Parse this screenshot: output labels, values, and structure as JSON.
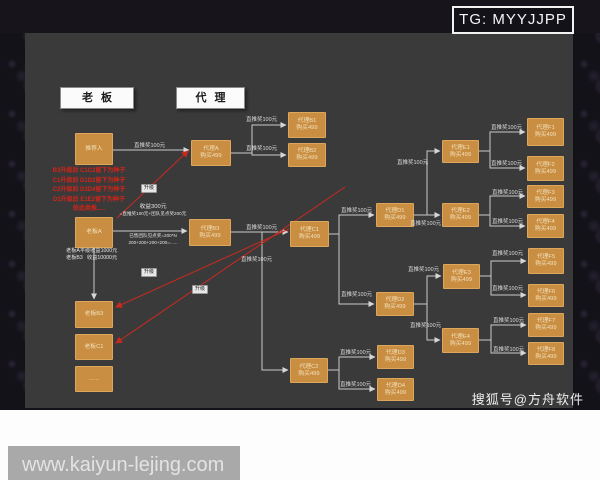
{
  "page": {
    "tg_badge": "TG: MYYJJPP",
    "souhu_watermark": "搜狐号@方舟软件",
    "url_watermark": "www.kaiyun-lejing.com"
  },
  "legend": {
    "boss": "老板",
    "agent": "代理"
  },
  "colors": {
    "panel": "#3b3a3b",
    "outer": "#141219",
    "node_fill": "#c98e41",
    "line": "#c9c9c9",
    "red": "#c92a1e"
  },
  "diagram": {
    "default_edge_label": "直推奖100元",
    "upgrade_label": "升级",
    "red_note_lines": [
      "B3升级后 C1C2留下为种子",
      "C1升级后 D1D2留下为种子",
      "C2升级后 D3D4留下为种子",
      "D1升级后 E1E2留下为种子",
      "依此类推....."
    ],
    "income_note": {
      "above": [
        "收益300元",
        "=直推奖100元+团队见点奖200元"
      ],
      "below": [
        "已售团队见点奖=200*N",
        "200+200+200+200=......"
      ]
    },
    "boss_income_lines": [
      "老板A平级收益1000元",
      "老板B3   收益10000元"
    ],
    "nodes": [
      {
        "id": "referrer",
        "label": "推荐人",
        "sub": "",
        "x": 75,
        "y": 133,
        "w": 38,
        "h": 32
      },
      {
        "id": "boss-a",
        "label": "老板A",
        "sub": "",
        "x": 75,
        "y": 217,
        "w": 38,
        "h": 31
      },
      {
        "id": "boss-b3",
        "label": "老板B3",
        "sub": "",
        "x": 75,
        "y": 301,
        "w": 38,
        "h": 27
      },
      {
        "id": "boss-c1",
        "label": "老板C1",
        "sub": "",
        "x": 75,
        "y": 334,
        "w": 38,
        "h": 26
      },
      {
        "id": "boss-more",
        "label": "......",
        "sub": "",
        "x": 75,
        "y": 366,
        "w": 38,
        "h": 26
      },
      {
        "id": "agent-a",
        "label": "代理A",
        "sub": "购买499",
        "x": 191,
        "y": 140,
        "w": 40,
        "h": 26
      },
      {
        "id": "agent-b3",
        "label": "代理B3",
        "sub": "购买499",
        "x": 189,
        "y": 219,
        "w": 42,
        "h": 27
      },
      {
        "id": "agent-b1",
        "label": "代理B1",
        "sub": "购买499",
        "x": 288,
        "y": 112,
        "w": 38,
        "h": 26
      },
      {
        "id": "agent-b2",
        "label": "代理B2",
        "sub": "购买499",
        "x": 288,
        "y": 143,
        "w": 38,
        "h": 24
      },
      {
        "id": "agent-c1",
        "label": "代理C1",
        "sub": "购买499",
        "x": 290,
        "y": 221,
        "w": 39,
        "h": 26
      },
      {
        "id": "agent-c2",
        "label": "代理C2",
        "sub": "购买499",
        "x": 290,
        "y": 358,
        "w": 38,
        "h": 25
      },
      {
        "id": "agent-d1",
        "label": "代理D1",
        "sub": "购买499",
        "x": 376,
        "y": 203,
        "w": 38,
        "h": 24
      },
      {
        "id": "agent-d2",
        "label": "代理D2",
        "sub": "购买499",
        "x": 376,
        "y": 292,
        "w": 38,
        "h": 24
      },
      {
        "id": "agent-d3",
        "label": "代理D3",
        "sub": "购买499",
        "x": 377,
        "y": 345,
        "w": 37,
        "h": 24
      },
      {
        "id": "agent-d4",
        "label": "代理D4",
        "sub": "购买499",
        "x": 377,
        "y": 378,
        "w": 37,
        "h": 23
      },
      {
        "id": "agent-e1",
        "label": "代理E1",
        "sub": "购买499",
        "x": 442,
        "y": 140,
        "w": 37,
        "h": 23
      },
      {
        "id": "agent-e2",
        "label": "代理E2",
        "sub": "购买499",
        "x": 442,
        "y": 203,
        "w": 37,
        "h": 24
      },
      {
        "id": "agent-e3",
        "label": "代理E3",
        "sub": "购买499",
        "x": 443,
        "y": 264,
        "w": 37,
        "h": 25
      },
      {
        "id": "agent-e4",
        "label": "代理E4",
        "sub": "购买499",
        "x": 442,
        "y": 328,
        "w": 37,
        "h": 25
      },
      {
        "id": "agent-f1",
        "label": "代理F1",
        "sub": "购买499",
        "x": 527,
        "y": 118,
        "w": 37,
        "h": 28
      },
      {
        "id": "agent-f2",
        "label": "代理F2",
        "sub": "购买499",
        "x": 527,
        "y": 156,
        "w": 37,
        "h": 25
      },
      {
        "id": "agent-f3",
        "label": "代理F3",
        "sub": "购买499",
        "x": 527,
        "y": 185,
        "w": 37,
        "h": 23
      },
      {
        "id": "agent-f4",
        "label": "代理F4",
        "sub": "购买499",
        "x": 527,
        "y": 214,
        "w": 37,
        "h": 24
      },
      {
        "id": "agent-f5",
        "label": "代理F5",
        "sub": "购买499",
        "x": 528,
        "y": 248,
        "w": 36,
        "h": 26
      },
      {
        "id": "agent-f6",
        "label": "代理F6",
        "sub": "购买499",
        "x": 528,
        "y": 284,
        "w": 36,
        "h": 23
      },
      {
        "id": "agent-f7",
        "label": "代理F7",
        "sub": "购买499",
        "x": 528,
        "y": 313,
        "w": 36,
        "h": 24
      },
      {
        "id": "agent-f8",
        "label": "代理F8",
        "sub": "购买499",
        "x": 528,
        "y": 342,
        "w": 36,
        "h": 23
      }
    ],
    "edges": [
      {
        "pts": [
          [
            113,
            150
          ],
          [
            189,
            150
          ]
        ],
        "lbl": [
          134,
          141
        ]
      },
      {
        "pts": [
          [
            231,
            153
          ],
          [
            252,
            153
          ],
          [
            252,
            125
          ],
          [
            286,
            125
          ]
        ],
        "lbl": [
          246,
          115
        ]
      },
      {
        "pts": [
          [
            252,
            153
          ],
          [
            252,
            155
          ],
          [
            286,
            155
          ]
        ],
        "lbl": [
          246,
          144
        ]
      },
      {
        "pts": [
          [
            113,
            231
          ],
          [
            187,
            231
          ]
        ]
      },
      {
        "pts": [
          [
            94,
            248
          ],
          [
            94,
            299
          ]
        ]
      },
      {
        "pts": [
          [
            231,
            232
          ],
          [
            288,
            232
          ]
        ],
        "lbl": [
          246,
          223
        ]
      },
      {
        "pts": [
          [
            262,
            232
          ],
          [
            262,
            370
          ],
          [
            288,
            370
          ]
        ],
        "lbl": [
          241,
          255
        ]
      },
      {
        "pts": [
          [
            329,
            234
          ],
          [
            339,
            234
          ],
          [
            339,
            215
          ],
          [
            374,
            215
          ]
        ],
        "lbl": [
          341,
          206
        ]
      },
      {
        "pts": [
          [
            339,
            234
          ],
          [
            339,
            304
          ],
          [
            374,
            304
          ]
        ],
        "lbl": [
          341,
          290
        ]
      },
      {
        "pts": [
          [
            328,
            370
          ],
          [
            339,
            370
          ],
          [
            339,
            357
          ],
          [
            375,
            357
          ]
        ],
        "lbl": [
          340,
          348
        ]
      },
      {
        "pts": [
          [
            339,
            370
          ],
          [
            339,
            389
          ],
          [
            375,
            389
          ]
        ],
        "lbl": [
          340,
          380
        ]
      },
      {
        "pts": [
          [
            414,
            215
          ],
          [
            440,
            215
          ]
        ],
        "lbl": [
          410,
          219
        ]
      },
      {
        "pts": [
          [
            427,
            215
          ],
          [
            427,
            151
          ],
          [
            440,
            151
          ]
        ],
        "lbl": [
          397,
          158
        ]
      },
      {
        "pts": [
          [
            479,
            151
          ],
          [
            490,
            151
          ],
          [
            490,
            132
          ],
          [
            525,
            132
          ]
        ],
        "lbl": [
          491,
          123
        ]
      },
      {
        "pts": [
          [
            490,
            151
          ],
          [
            490,
            168
          ],
          [
            525,
            168
          ]
        ],
        "lbl": [
          491,
          159
        ]
      },
      {
        "pts": [
          [
            479,
            215
          ],
          [
            490,
            215
          ],
          [
            490,
            196
          ],
          [
            525,
            196
          ]
        ],
        "lbl": [
          492,
          188
        ]
      },
      {
        "pts": [
          [
            490,
            215
          ],
          [
            490,
            226
          ],
          [
            525,
            226
          ]
        ],
        "lbl": [
          492,
          217
        ]
      },
      {
        "pts": [
          [
            414,
            304
          ],
          [
            427,
            304
          ],
          [
            427,
            276
          ],
          [
            441,
            276
          ]
        ],
        "lbl": [
          408,
          265
        ]
      },
      {
        "pts": [
          [
            427,
            304
          ],
          [
            427,
            340
          ],
          [
            440,
            340
          ]
        ],
        "lbl": [
          410,
          321
        ]
      },
      {
        "pts": [
          [
            480,
            276
          ],
          [
            491,
            276
          ],
          [
            491,
            261
          ],
          [
            526,
            261
          ]
        ],
        "lbl": [
          492,
          249
        ]
      },
      {
        "pts": [
          [
            491,
            276
          ],
          [
            491,
            295
          ],
          [
            526,
            295
          ]
        ],
        "lbl": [
          492,
          284
        ]
      },
      {
        "pts": [
          [
            479,
            340
          ],
          [
            491,
            340
          ],
          [
            491,
            325
          ],
          [
            526,
            325
          ]
        ],
        "lbl": [
          493,
          316
        ]
      },
      {
        "pts": [
          [
            491,
            340
          ],
          [
            491,
            353
          ],
          [
            526,
            353
          ]
        ],
        "lbl": [
          493,
          345
        ]
      }
    ],
    "red_links": [
      {
        "pts": [
          [
            117,
            218
          ],
          [
            188,
            151
          ]
        ],
        "lbl": [
          141,
          184
        ]
      },
      {
        "pts": [
          [
            289,
            229
          ],
          [
            116,
            307
          ]
        ],
        "lbl": [
          141,
          268
        ]
      },
      {
        "pts": [
          [
            345,
            187
          ],
          [
            116,
            343
          ]
        ],
        "lbl": [
          192,
          285
        ]
      }
    ]
  }
}
